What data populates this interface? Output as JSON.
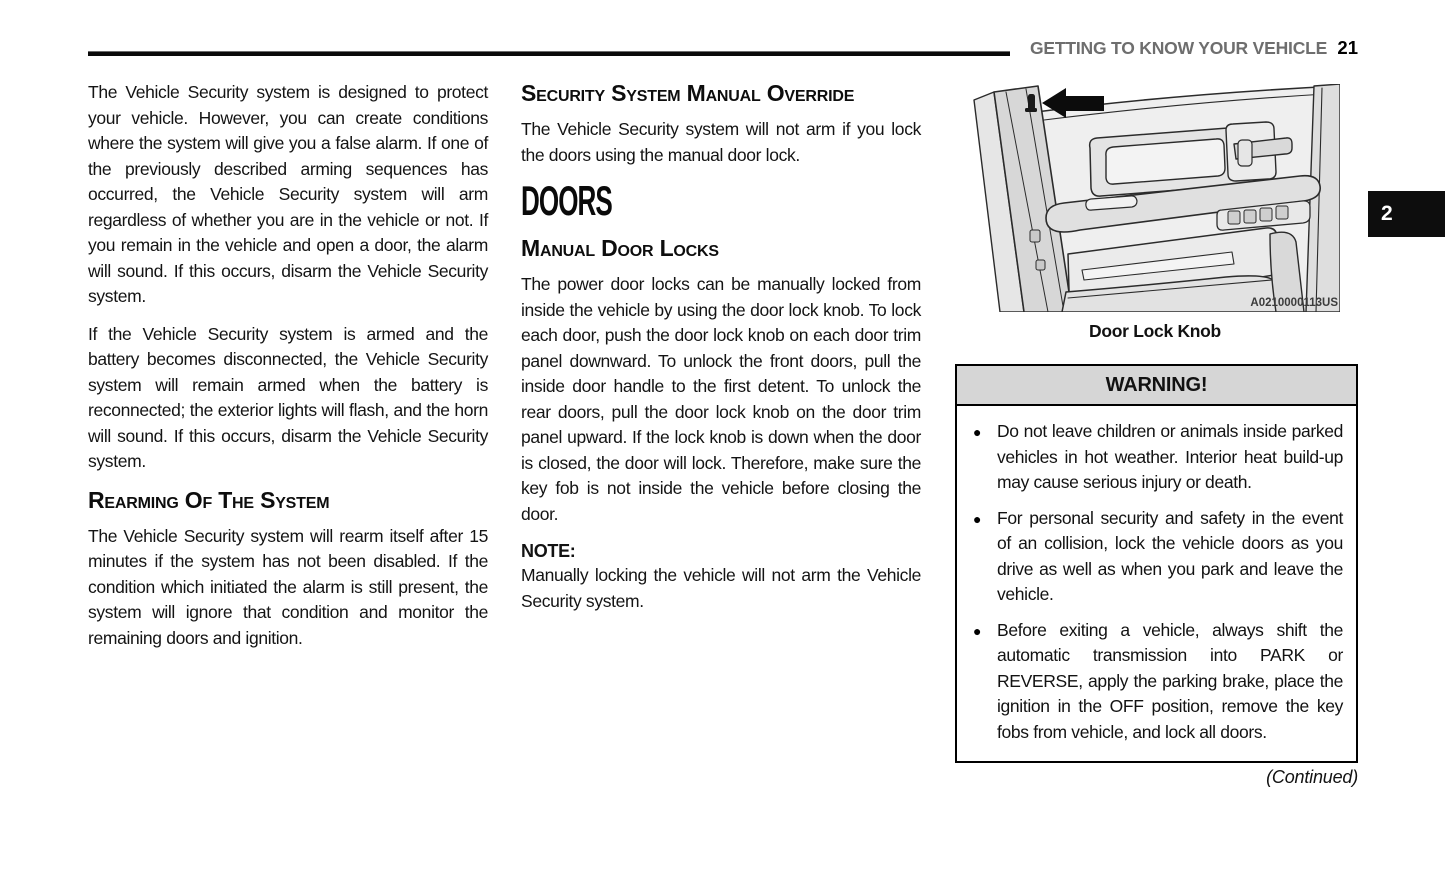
{
  "header": {
    "section_title": "GETTING TO KNOW YOUR VEHICLE",
    "page_number": "21"
  },
  "side_tab": {
    "chapter_number": "2"
  },
  "columns": {
    "left": {
      "para1": "The Vehicle Security system is designed to protect your vehicle. However, you can create conditions where the system will give you a false alarm. If one of the previously described arming sequences has occurred, the Vehicle Security system will arm regardless of whether you are in the vehicle or not. If you remain in the vehicle and open a door, the alarm will sound. If this occurs, disarm the Vehicle Security system.",
      "para2": "If the Vehicle Security system is armed and the battery becomes disconnected, the Vehicle Security system will remain armed when the battery is reconnected; the exterior lights will flash, and the horn will sound. If this occurs, disarm the Vehicle Security system.",
      "heading_rearming": "Rearming Of The System",
      "para3": "The Vehicle Security system will rearm itself after 15 minutes if the system has not been disabled. If the condition which initiated the alarm is still present, the system will ignore that condition and monitor the remaining doors and ignition."
    },
    "middle": {
      "heading_override": "Security System Manual Override",
      "para_override": "The Vehicle Security system will not arm if you lock the doors using the manual door lock.",
      "heading_doors": "DOORS",
      "heading_manual_locks": "Manual Door Locks",
      "para_manual_locks": "The power door locks can be manually locked from inside the vehicle by using the door lock knob. To lock each door, push the door lock knob on each door trim panel downward. To unlock the front doors, pull the inside door handle to the first detent. To unlock the rear doors, pull the door lock knob on the door trim panel upward. If the lock knob is down when the door is closed, the door will lock. Therefore, make sure the key fob is not inside the vehicle before closing the door.",
      "note_label": "NOTE:",
      "note_text": "Manually locking the vehicle will not arm the Vehicle Security system."
    },
    "right": {
      "figure": {
        "code": "A0210000113US",
        "caption": "Door Lock Knob"
      },
      "warning": {
        "title": "WARNING!",
        "bullets": [
          "Do not leave children or animals inside parked vehicles in hot weather. Interior heat build-up may cause serious injury or death.",
          "For personal security and safety in the event of an collision, lock the vehicle doors as you drive as well as when you park and leave the vehicle.",
          "Before exiting a vehicle, always shift the automatic transmission into PARK or REVERSE, apply the parking brake, place the ignition in the OFF position, remove the key fobs from vehicle, and lock all doors."
        ]
      },
      "continued": "(Continued)"
    }
  },
  "icons": {
    "bullet": "●"
  },
  "colors": {
    "tab_background": "#0d0d0d",
    "warning_header_background": "#d6d6d6",
    "header_text": "#6e6e6e",
    "rule": "#0a0a0a",
    "body_text": "#141414"
  }
}
